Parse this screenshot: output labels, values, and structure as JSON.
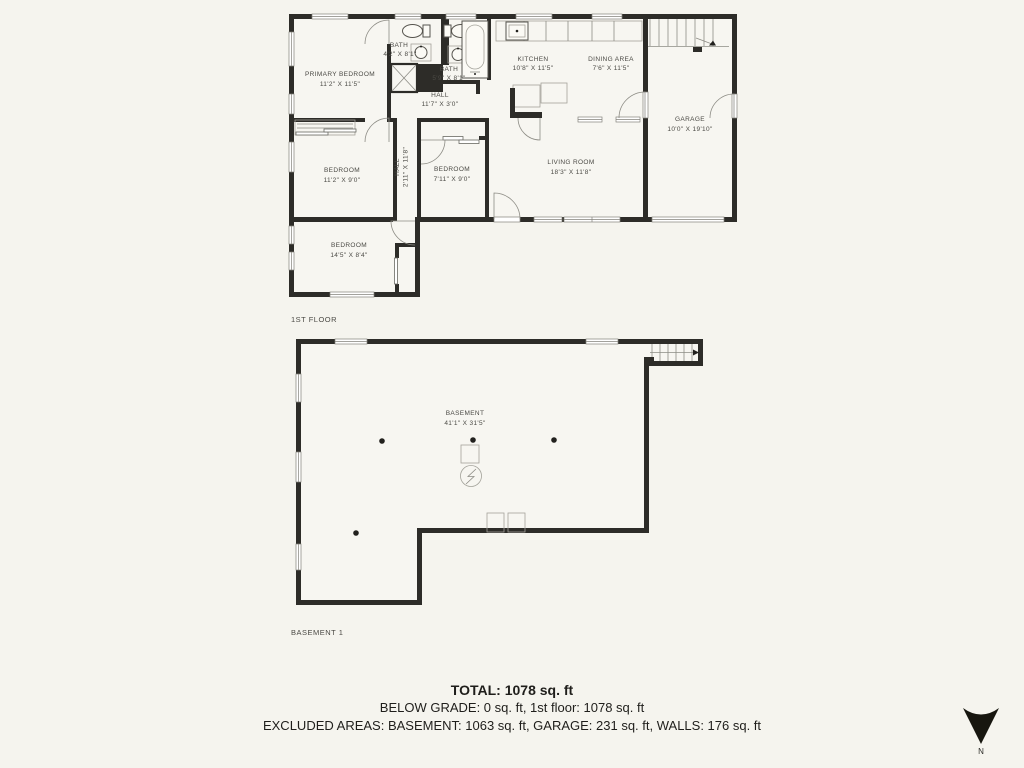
{
  "first_floor": {
    "label": "1ST FLOOR",
    "rooms": [
      {
        "name": "PRIMARY BEDROOM",
        "dims": "11'2\" X 11'5\""
      },
      {
        "name": "BATH",
        "dims": "4'2\" X 8'1\""
      },
      {
        "name": "BATH",
        "dims": "5'9\" X 8'1\""
      },
      {
        "name": "HALL",
        "dims": "11'7\" X 3'0\""
      },
      {
        "name": "KITCHEN",
        "dims": "10'8\" X 11'5\""
      },
      {
        "name": "DINING AREA",
        "dims": "7'6\" X 11'5\""
      },
      {
        "name": "GARAGE",
        "dims": "10'0\" X 19'10\""
      },
      {
        "name": "BEDROOM",
        "dims": "11'2\" X 9'0\""
      },
      {
        "name": "HALL",
        "dims": "2'11\" X 11'8\""
      },
      {
        "name": "BEDROOM",
        "dims": "7'11\" X 9'0\""
      },
      {
        "name": "LIVING ROOM",
        "dims": "18'3\" X 11'8\""
      },
      {
        "name": "BEDROOM",
        "dims": "14'5\" X 8'4\""
      }
    ]
  },
  "basement_floor": {
    "label": "BASEMENT 1",
    "rooms": [
      {
        "name": "BASEMENT",
        "dims": "41'1\" X 31'5\""
      }
    ]
  },
  "summary": {
    "total": "TOTAL: 1078 sq. ft",
    "below_grade": "BELOW GRADE: 0 sq. ft, 1st floor: 1078 sq. ft",
    "excluded": "EXCLUDED AREAS: BASEMENT: 1063 sq. ft, GARAGE: 231 sq. ft, WALLS: 176 sq. ft"
  },
  "compass": {
    "label": "N"
  },
  "colors": {
    "background": "#f5f4ee",
    "floor": "#f7f6f1",
    "wall": "#2d2c28",
    "line": "#8d8c85",
    "plan_text": "#4b4a45",
    "summary_text": "#1f1e1b"
  }
}
